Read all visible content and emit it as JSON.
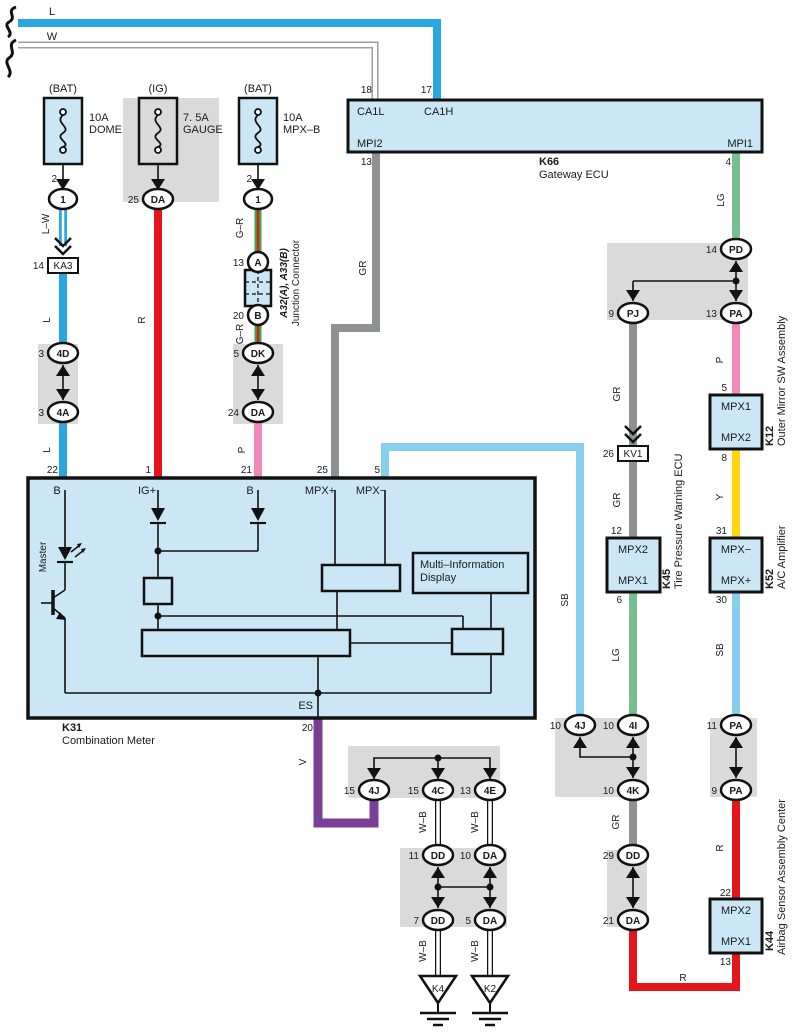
{
  "colors": {
    "wire_blue": "#29A7E0",
    "wire_red": "#E6151C",
    "wire_green": "#2FAF4C",
    "wire_pink": "#F287BB",
    "wire_gray": "#8F9294",
    "wire_light_green": "#76BF8E",
    "wire_sky_blue": "#86CFF0",
    "wire_yellow": "#FFD60A",
    "wire_violet": "#7A3E98",
    "box_fill": "#CBE7F6",
    "panel_gray": "#DADADA"
  },
  "feed": {
    "l": "L",
    "w": "W"
  },
  "gateway": {
    "id": "K66",
    "name": "Gateway ECU",
    "ca1l": "CA1L",
    "ca1h": "CA1H",
    "mpi2": "MPI2",
    "mpi1": "MPI1",
    "p18": "18",
    "p17": "17",
    "p13": "13",
    "p4": "4"
  },
  "fuses": [
    {
      "head": "(BAT)",
      "rating": "10A",
      "name": "DOME",
      "pin": "2"
    },
    {
      "head": "(IG)",
      "rating": "7. 5A",
      "name": "GAUGE"
    },
    {
      "head": "(BAT)",
      "rating": "10A",
      "name": "MPX–B",
      "pin": "2"
    }
  ],
  "junction": {
    "id": "A32(A), A33(B)",
    "name": "Junction Connector"
  },
  "relay_boxes": [
    {
      "num": "14",
      "code": "KA3"
    },
    {
      "num": "26",
      "code": "KV1"
    }
  ],
  "meter": {
    "id": "K31",
    "name": "Combination Meter",
    "master": "Master",
    "display_line1": "Multi–Information",
    "display_line2": "Display",
    "es": "ES",
    "p20": "20",
    "pins_top": [
      "22",
      "1",
      "21",
      "25",
      "5"
    ],
    "pin_names": [
      "B",
      "IG+",
      "B",
      "MPX+",
      "MPX−"
    ]
  },
  "ecus": [
    {
      "id": "K12",
      "name": "Outer Mirror SW Assembly",
      "top": "MPX1",
      "bottom": "MPX2",
      "pin_top": "5",
      "pin_bottom": "8"
    },
    {
      "id": "K45",
      "name": "Tire Pressure Warning ECU",
      "top": "MPX2",
      "bottom": "MPX1",
      "pin_top": "12",
      "pin_bottom": "6"
    },
    {
      "id": "K52",
      "name": "A/C Amplifier",
      "top": "MPX−",
      "bottom": "MPX+",
      "pin_top": "31",
      "pin_bottom": "30"
    },
    {
      "id": "K44",
      "name": "Airbag Sensor Assembly Center",
      "top": "MPX2",
      "bottom": "MPX1",
      "pin_top": "22",
      "pin_bottom": "13"
    }
  ],
  "ovals": [
    {
      "num": "",
      "code": "1"
    },
    {
      "num": "25",
      "code": "DA"
    },
    {
      "num": "",
      "code": "1"
    },
    {
      "num": "13",
      "code": "A"
    },
    {
      "num": "20",
      "code": "B"
    },
    {
      "num": "3",
      "code": "4D"
    },
    {
      "num": "3",
      "code": "4A"
    },
    {
      "num": "5",
      "code": "DK"
    },
    {
      "num": "24",
      "code": "DA"
    },
    {
      "num": "14",
      "code": "PD"
    },
    {
      "num": "9",
      "code": "PJ"
    },
    {
      "num": "13",
      "code": "PA"
    },
    {
      "num": "10",
      "code": "4J"
    },
    {
      "num": "10",
      "code": "4I"
    },
    {
      "num": "10",
      "code": "4K"
    },
    {
      "num": "29",
      "code": "DD"
    },
    {
      "num": "21",
      "code": "DA"
    },
    {
      "num": "11",
      "code": "PA"
    },
    {
      "num": "9",
      "code": "PA"
    },
    {
      "num": "15",
      "code": "4J"
    },
    {
      "num": "15",
      "code": "4C"
    },
    {
      "num": "13",
      "code": "4E"
    },
    {
      "num": "11",
      "code": "DD"
    },
    {
      "num": "10",
      "code": "DA"
    },
    {
      "num": "7",
      "code": "DD"
    },
    {
      "num": "5",
      "code": "DA"
    }
  ],
  "wire_labels": [
    "L–W",
    "L",
    "L",
    "R",
    "G–R",
    "G–R",
    "P",
    "GR",
    "SB",
    "LG",
    "P",
    "Y",
    "SB",
    "GR",
    "GR",
    "LG",
    "GR",
    "V",
    "R",
    "R",
    "W–B",
    "W–B",
    "W–B",
    "W–B"
  ],
  "grounds": [
    "K4",
    "K2"
  ]
}
